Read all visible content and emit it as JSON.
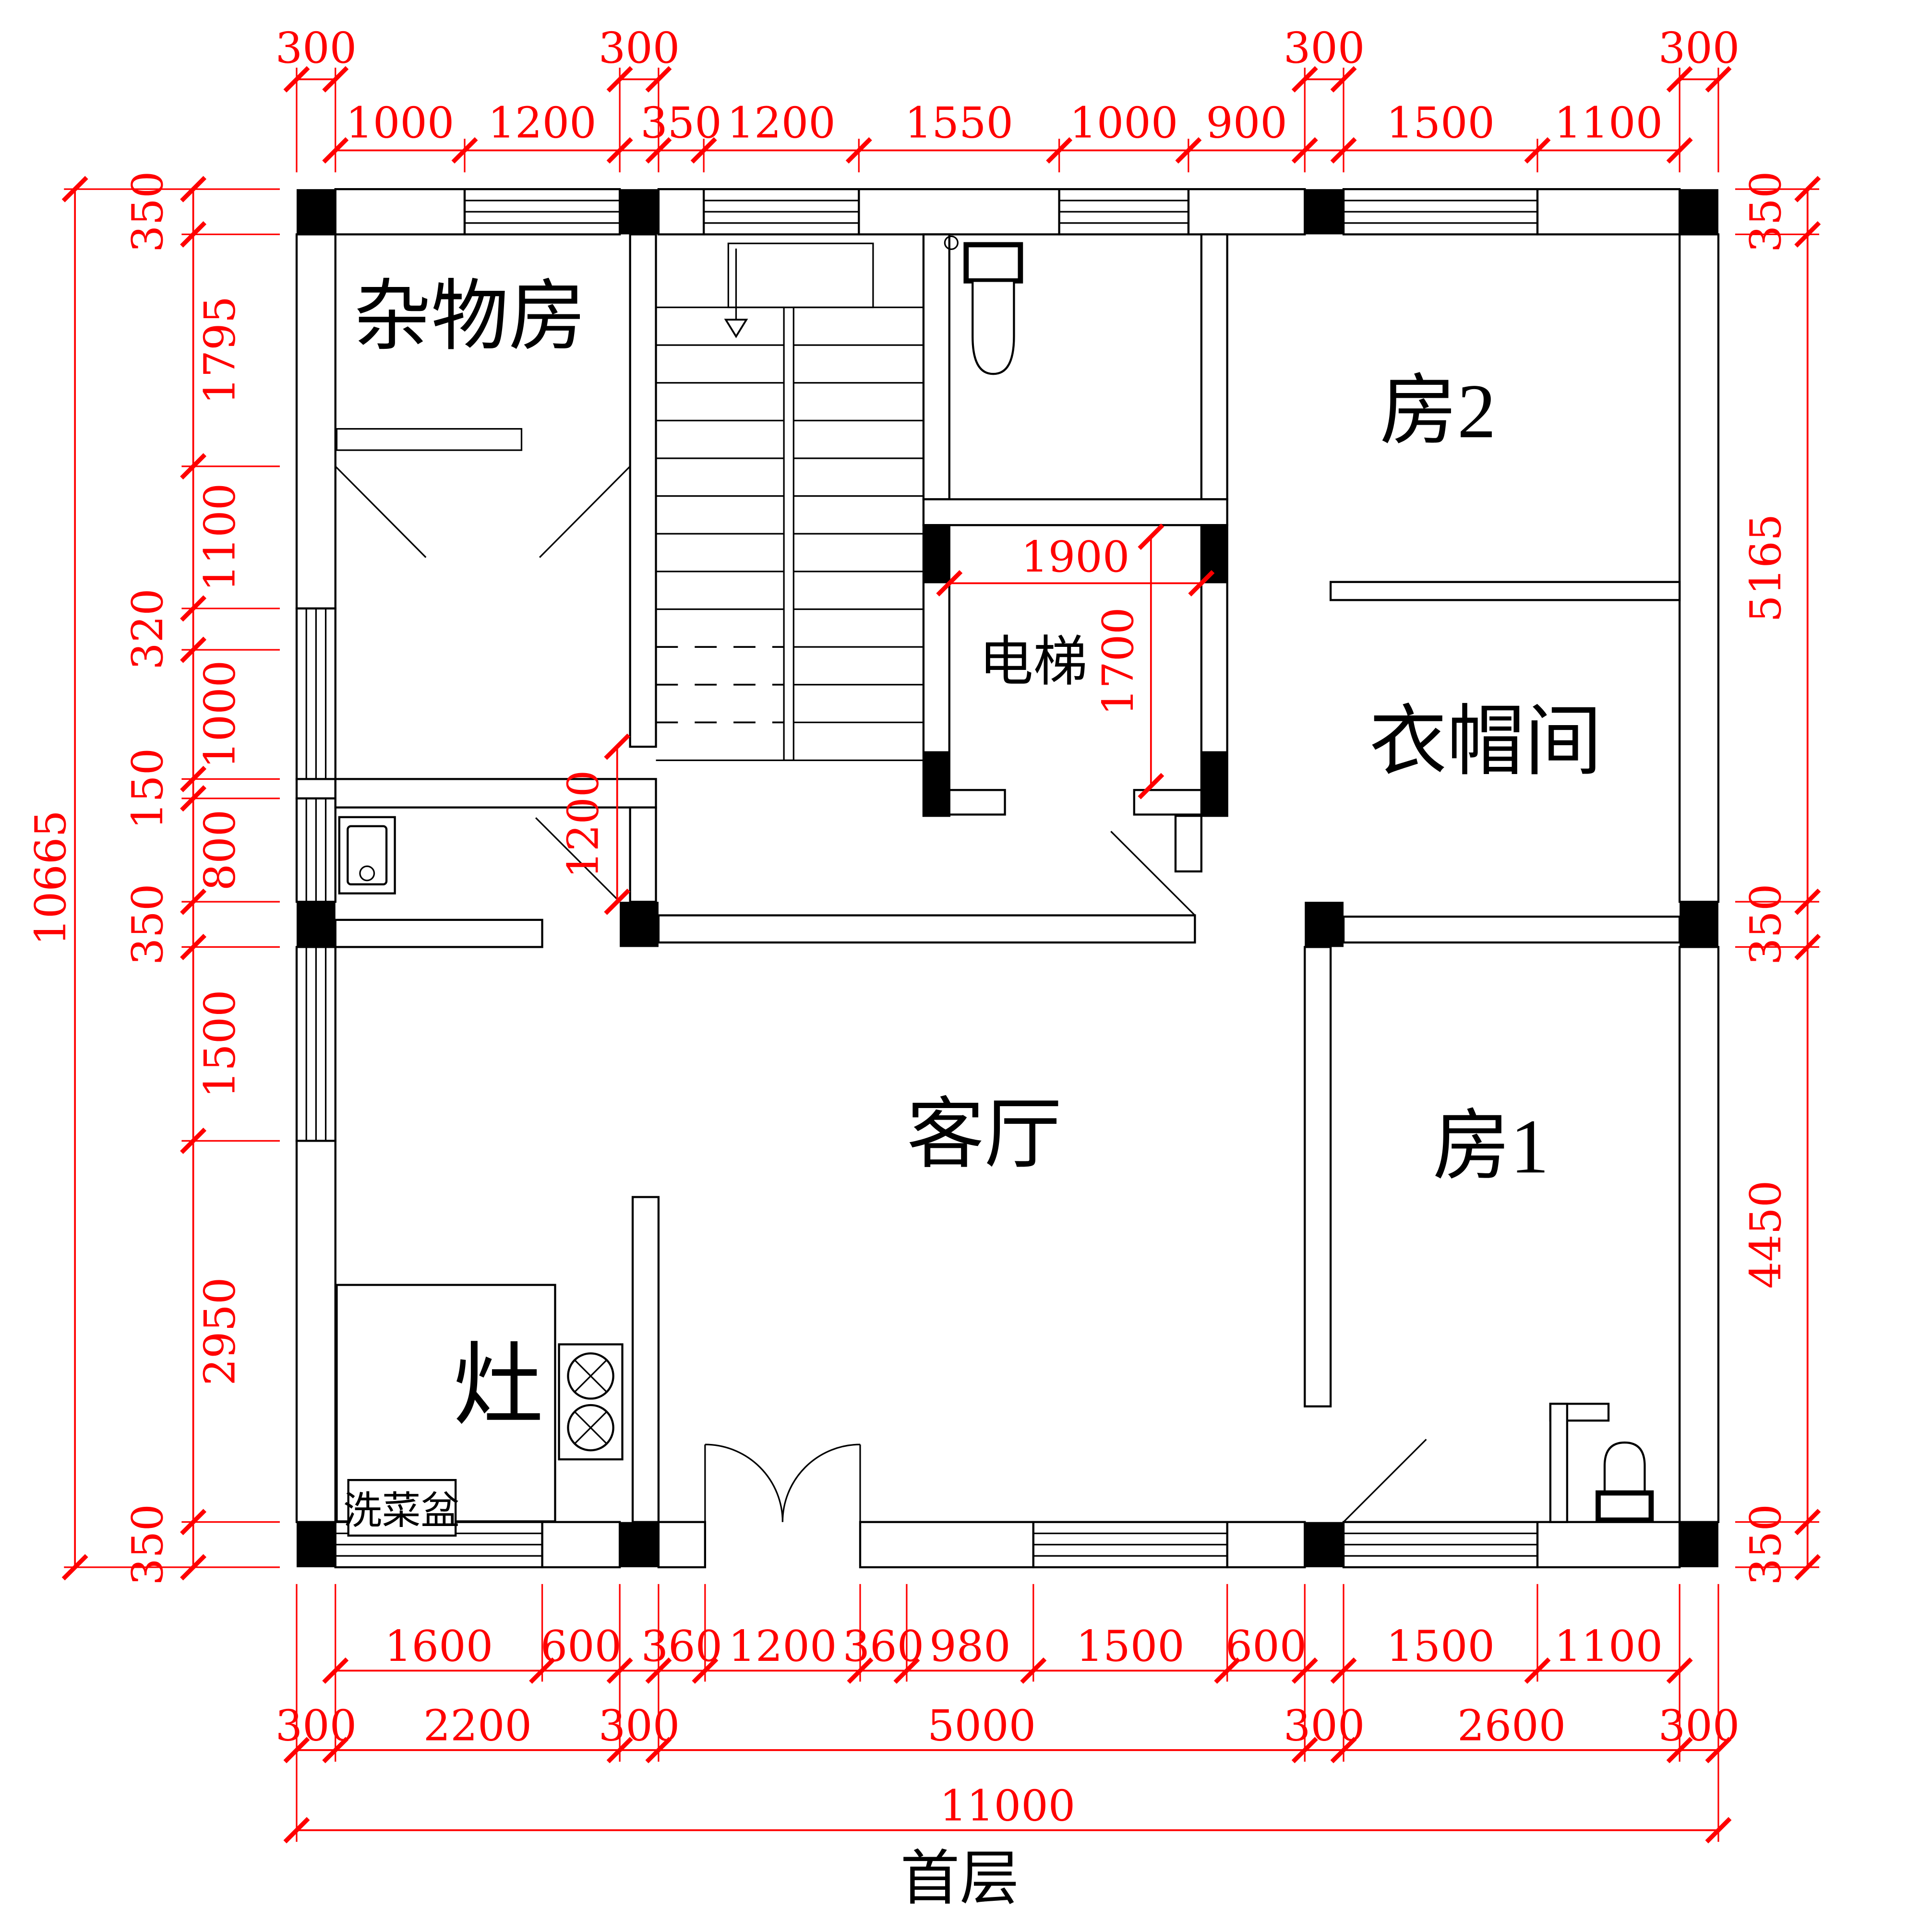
{
  "title": "首层",
  "rooms": {
    "storage": "杂物房",
    "room2": "房2",
    "elevator": "电梯",
    "cloakroom": "衣帽间",
    "living": "客厅",
    "room1": "房1",
    "stove": "灶",
    "sink": "洗菜盆"
  },
  "dims": {
    "top_cols": [
      "300",
      "300",
      "300",
      "300"
    ],
    "top": [
      "1000",
      "1200",
      "350",
      "1200",
      "1550",
      "1000",
      "900",
      "1500",
      "1100"
    ],
    "left_total": "10665",
    "left": [
      "350",
      "1795",
      "1100",
      "320",
      "1000",
      "150",
      "800",
      "350",
      "1500",
      "2950",
      "350"
    ],
    "right": [
      "350",
      "5165",
      "350",
      "4450",
      "350"
    ],
    "bottom1": [
      "1600",
      "600",
      "360",
      "1200",
      "360",
      "980",
      "1500",
      "600",
      "1500",
      "1100"
    ],
    "bottom2": [
      "300",
      "2200",
      "300",
      "5000",
      "300",
      "2600",
      "300"
    ],
    "bottom_total": "11000",
    "interior": {
      "elevator_w": "1900",
      "elevator_h": "1700",
      "corridor": "1200"
    }
  },
  "colors": {
    "dimension": "#ff0000",
    "wall": "#000000"
  }
}
